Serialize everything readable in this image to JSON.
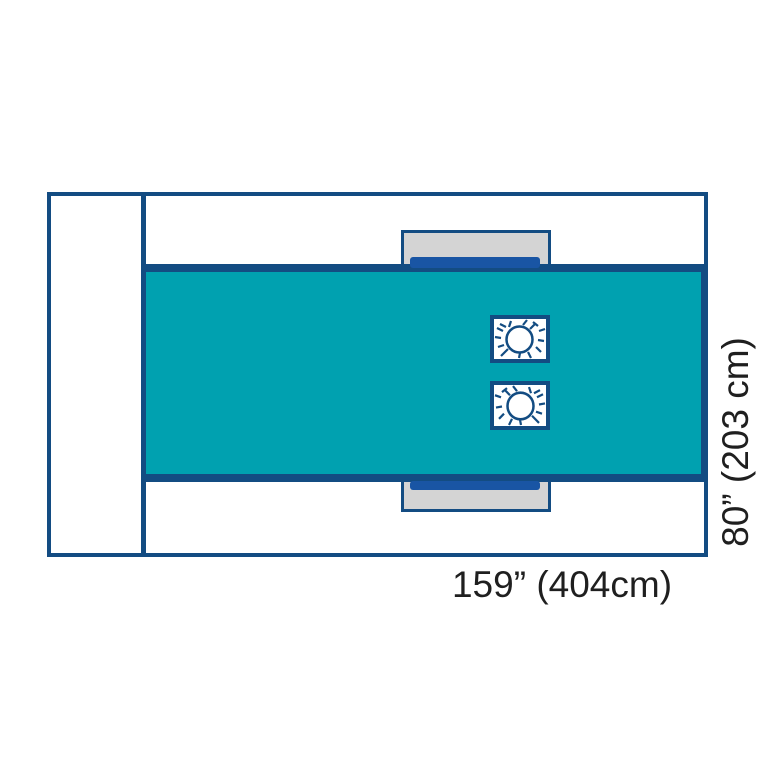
{
  "diagram": {
    "subject": "surgical drape dimensional diagram",
    "labels": {
      "width": "159” (404cm)",
      "height": "80” (203 cm)"
    },
    "colors": {
      "outline": "#134C82",
      "drape": "#00A1B0",
      "tab": "#D4D4D4",
      "tab_bar": "#1955A4",
      "text": "#1F1F1F",
      "background": "#FFFFFF"
    },
    "fenestrations": [
      {
        "name": "fenestration-upper"
      },
      {
        "name": "fenestration-lower"
      }
    ]
  }
}
